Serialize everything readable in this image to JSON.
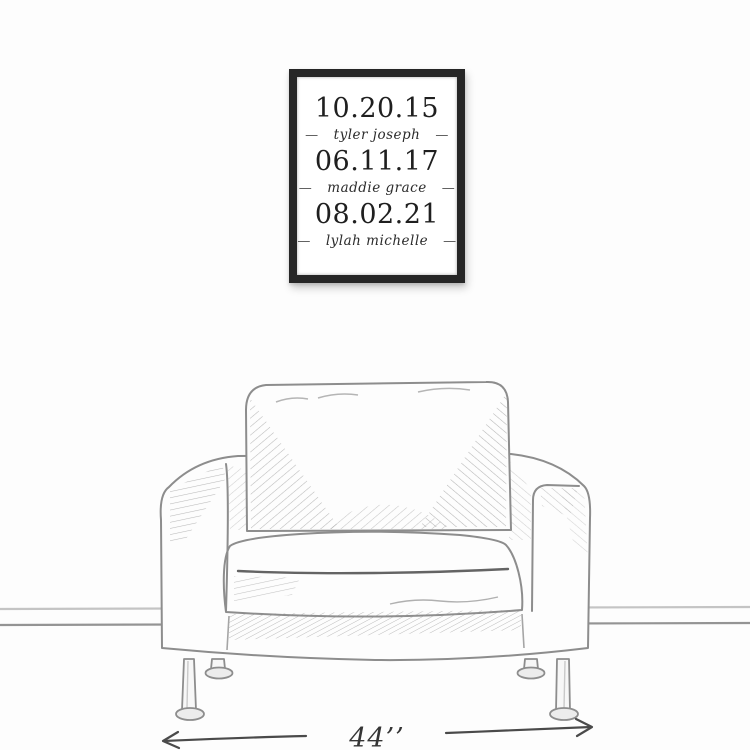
{
  "page": {
    "background": "#fdfdfd"
  },
  "wall_art": {
    "frame_color": "#262626",
    "text_color": "#1f1f1f",
    "separator": "—",
    "entries": [
      {
        "date": "10.20.15",
        "name": "tyler joseph"
      },
      {
        "date": "06.11.17",
        "name": "maddie grace"
      },
      {
        "date": "08.02.21",
        "name": "lylah michelle"
      }
    ]
  },
  "sketch": {
    "subject": "armchair-line-drawing",
    "line_color": "#8d8d8d",
    "arrow_color": "#4a4a4a"
  },
  "dimension": {
    "label": "44’’"
  }
}
